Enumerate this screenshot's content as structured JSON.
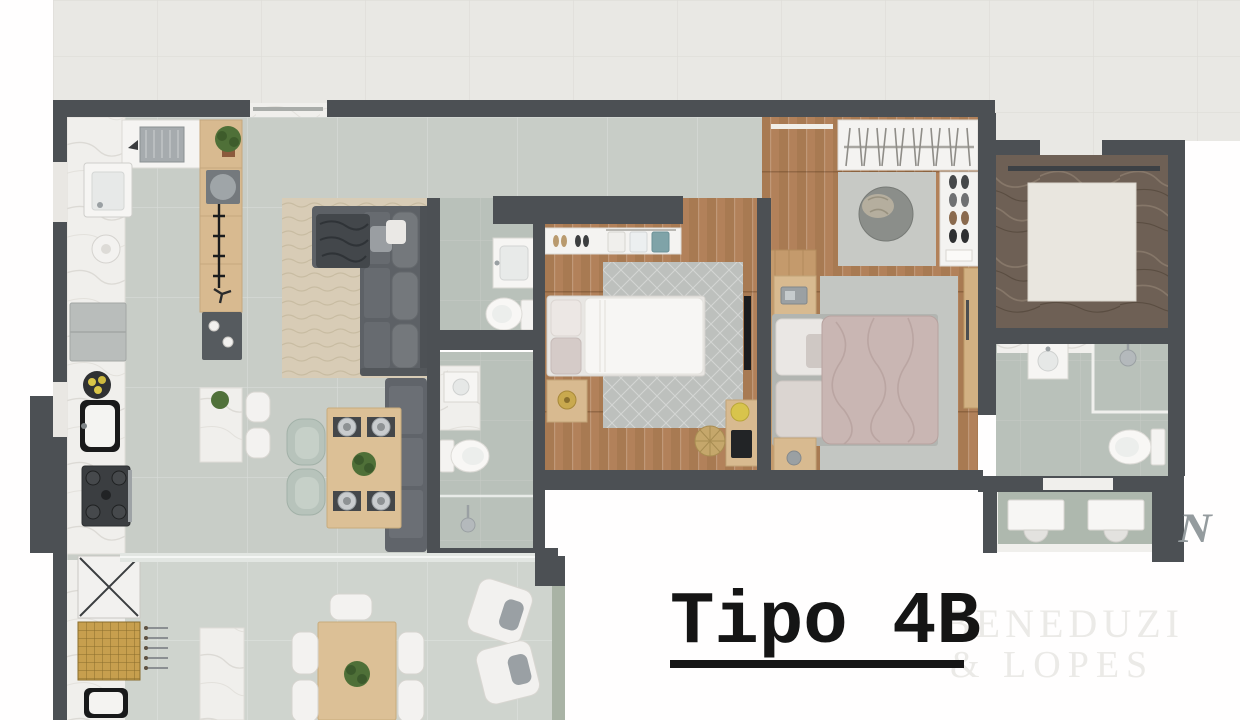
{
  "title": {
    "label": "Tipo 4B"
  },
  "watermark": {
    "line1": "BENEDUZI",
    "line2": "& LOPES",
    "corner_monogram": "N"
  },
  "palette": {
    "wall": "#4c5054",
    "exterior_tile": "#e9e8e4",
    "interior_floor": "#c8cdc7",
    "bathroom_floor": "#b9c1ba",
    "terrace_floor": "#cfd4ce",
    "wood_floor": "#b2815a",
    "wood_furniture": "#d8ba90",
    "marble_light": "#f0efec",
    "marble_dark": "#6e6055",
    "sofa_gray": "#5d6166",
    "rug_beige": "#d8ccb6",
    "duvet_white": "#f7f6f4",
    "duvet_mauve": "#c9b6b3",
    "chair_green": "#b7c3bb",
    "barbecue_gold": "#c79f4e",
    "accent_yellow": "#d8c44c",
    "title_color": "#151515",
    "watermark_color": "#ebeae7",
    "monogram_color": "#949b9e"
  }
}
